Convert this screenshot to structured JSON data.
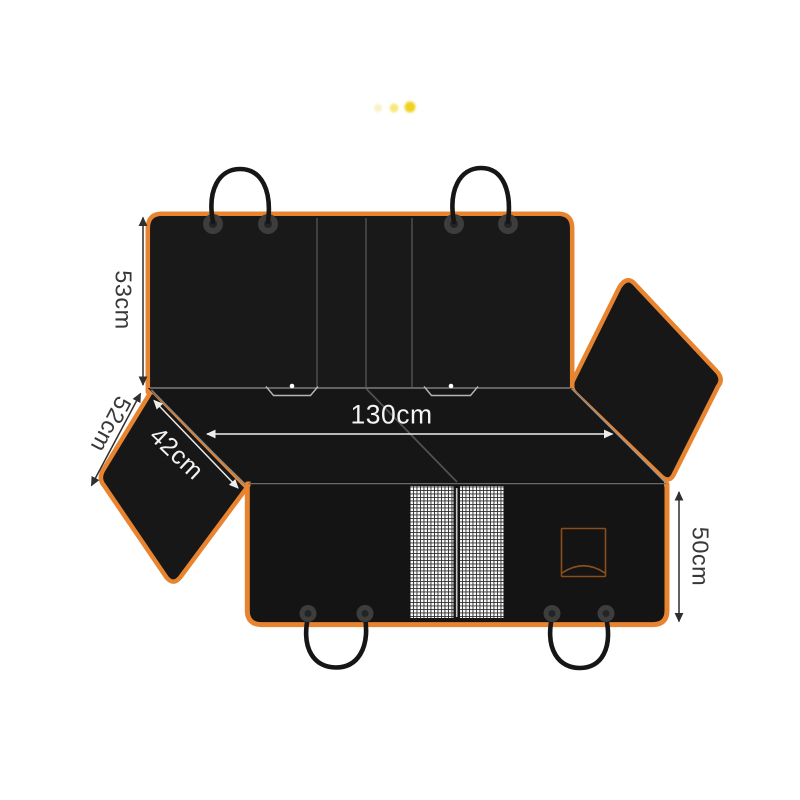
{
  "image": {
    "background": "#ffffff",
    "kind": "product-dimension-diagram"
  },
  "carousel": {
    "dots": [
      {
        "name": "dot-1",
        "color": "#f8f2c6"
      },
      {
        "name": "dot-2",
        "color": "#f6e87e"
      },
      {
        "name": "dot-3",
        "color": "#f0d320"
      }
    ]
  },
  "diagram": {
    "colors": {
      "trim": "#e8842f",
      "fabric": "#181818",
      "fabric_dark": "#141414",
      "seam": "#474747",
      "fold_line": "#8a8a8a",
      "mesh_background": "#f9f9f9",
      "mesh_grid": "#2c2c2c",
      "pocket_outline": "#8a4e1d",
      "strap": "#161616",
      "label_dark": "#383838",
      "label_light": "#f2f2f2"
    },
    "labels": {
      "back_height": "53cm",
      "side_flap_length": "52cm",
      "side_flap_width": "42cm",
      "total_width": "130cm",
      "front_height": "50cm"
    }
  }
}
